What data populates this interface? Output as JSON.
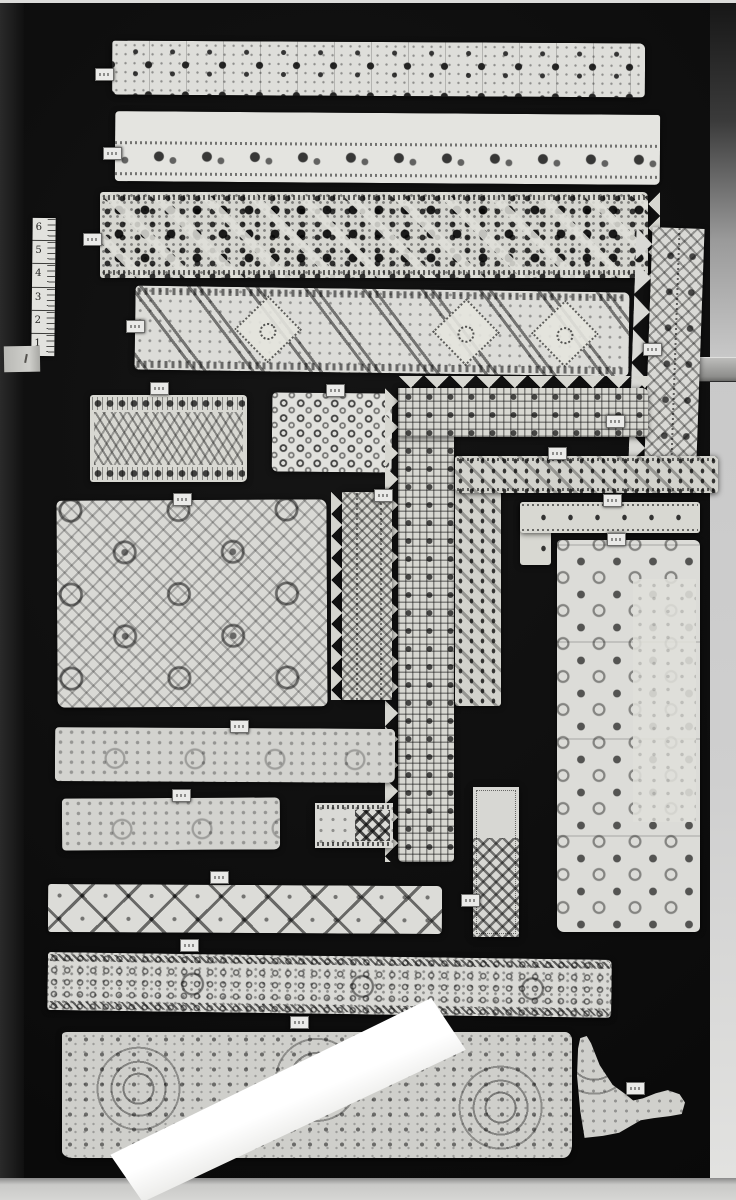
{
  "scene": {
    "type": "black-and-white photograph",
    "subject": "lace and embroidery specimens pinned to a black mounting board",
    "board_color": "#0c0c0c",
    "lace_color": "#d9d9d3",
    "paper_strip_color": "#fbfbfb",
    "frame_edge_color": "#cccccc"
  },
  "ruler": {
    "marks": [
      "6",
      "5",
      "4",
      "3",
      "2",
      "1"
    ]
  },
  "pieces": [
    {
      "name": "lace-band-1",
      "kind": "horizontal cutwork band with square compartments"
    },
    {
      "name": "lace-band-2",
      "kind": "horizontal band, plain top, embroidered lower border"
    },
    {
      "name": "lace-band-3",
      "kind": "dense reticella openwork band"
    },
    {
      "name": "lace-band-4",
      "kind": "band with diagonal lattice and diamond medallions"
    },
    {
      "name": "lace-edging-right",
      "kind": "vertical edging with triangular scallops"
    },
    {
      "name": "lace-panel-meander",
      "kind": "rectangular panel, wave meander pattern"
    },
    {
      "name": "lace-panel-eyelet",
      "kind": "rectangular panel, diagonal eyelet dots"
    },
    {
      "name": "lace-corner-border-1",
      "kind": "L-shaped border with picot scalloped outer edge"
    },
    {
      "name": "lace-corner-border-2",
      "kind": "L-shaped border with eyelet rows"
    },
    {
      "name": "lace-corner-border-3",
      "kind": "L-shaped border with single eyelet row"
    },
    {
      "name": "lace-sampler-square",
      "kind": "large panel, interlace with diamond medallions"
    },
    {
      "name": "lace-edging-middle",
      "kind": "narrow vertical edging with zigzag edge"
    },
    {
      "name": "lace-sampler-tall",
      "kind": "tall panel with scattered openwork squares"
    },
    {
      "name": "lace-band-5",
      "kind": "faintly patterned band"
    },
    {
      "name": "lace-band-6",
      "kind": "faintly patterned band"
    },
    {
      "name": "lace-band-7",
      "kind": "small band with dark cross motifs"
    },
    {
      "name": "lace-band-8",
      "kind": "band with repeating X motifs"
    },
    {
      "name": "lace-strip-vertical-x",
      "kind": "small vertical strip with cross motifs"
    },
    {
      "name": "lace-band-9",
      "kind": "long band with dense eyelet rings"
    },
    {
      "name": "lace-panel-bottom",
      "kind": "wide panel with dotted scroll pattern"
    },
    {
      "name": "paper-strip-overlay",
      "kind": "blank white paper strip laid diagonally"
    },
    {
      "name": "lace-fragment-triangle",
      "kind": "triangular lace fragment with tail"
    }
  ],
  "tags": {
    "count": 20,
    "note": "small white specimen tags, printed numbers illegible"
  }
}
